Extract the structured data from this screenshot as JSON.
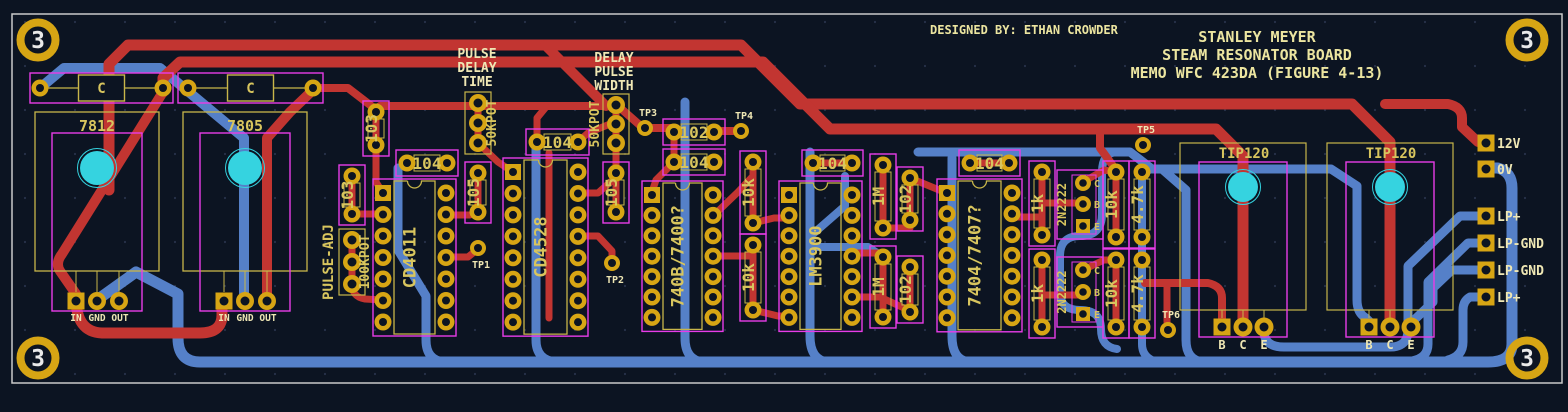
{
  "app": {
    "view": "pcb-layout-editor"
  },
  "title_block": {
    "designer": "DESIGNED BY: ETHAN CROWDER",
    "line1": "STANLEY MEYER",
    "line2": "STEAM RESONATOR BOARD",
    "line3": "MEMO WFC 423DA (FIGURE 4-13)"
  },
  "colors": {
    "background": "#0c1422",
    "grid_dot": "#273149",
    "page_border": "#c9c9c9",
    "copper_top": "#c23531",
    "copper_bottom": "#5580c8",
    "pad_gold": "#d7a514",
    "silk_yellow": "#c8b64a",
    "silk_text": "#d8c55e",
    "silk_bright": "#efe7b4",
    "courtyard_pink": "#e83ce8",
    "hole_cyan": "#35d3e0",
    "hole_number": "#e9e9e9"
  },
  "mounting_hole_label": "3",
  "mounting_holes": [
    {
      "x": 38,
      "y": 40
    },
    {
      "x": 1527,
      "y": 40
    },
    {
      "x": 38,
      "y": 358
    },
    {
      "x": 1527,
      "y": 358
    }
  ],
  "headers": [
    {
      "lines": [
        "PULSE",
        "DELAY",
        "TIME"
      ],
      "x": 477,
      "y": 58
    },
    {
      "lines": [
        "DELAY",
        "PULSE",
        "WIDTH"
      ],
      "x": 614,
      "y": 62
    }
  ],
  "capacitors": [
    {
      "label": "C",
      "x1": 40,
      "x2": 163,
      "y": 88
    },
    {
      "label": "C",
      "x1": 188,
      "x2": 313,
      "y": 88
    }
  ],
  "regulators": [
    {
      "label": "7812",
      "cx": 97,
      "pins": [
        "IN",
        "GND",
        "OUT"
      ]
    },
    {
      "label": "7805",
      "cx": 245,
      "pins": [
        "IN",
        "GND",
        "OUT"
      ]
    }
  ],
  "ics": [
    {
      "label": "CD4011",
      "colL": 383,
      "colR": 446,
      "y0": 193,
      "dy": 21.5,
      "n": 7
    },
    {
      "label": "CD4528",
      "colL": 513,
      "colR": 578,
      "y0": 172,
      "dy": 21.45,
      "n": 8
    },
    {
      "label": "740B/7400?",
      "colL": 652,
      "colR": 713,
      "y0": 195,
      "dy": 20.4,
      "n": 7
    },
    {
      "label": "LM3900",
      "colL": 789,
      "colR": 852,
      "y0": 195,
      "dy": 20.4,
      "n": 7
    },
    {
      "label": "7404/7407?",
      "colL": 947,
      "colR": 1012,
      "y0": 193,
      "dy": 20.8,
      "n": 7
    }
  ],
  "resistors_v": [
    {
      "label": "103",
      "x": 376,
      "y1": 112,
      "y2": 145
    },
    {
      "label": "103",
      "x": 352,
      "y1": 176,
      "y2": 214
    },
    {
      "label": "105",
      "x": 478,
      "y1": 173,
      "y2": 212
    },
    {
      "label": "105",
      "x": 616,
      "y1": 173,
      "y2": 212
    },
    {
      "label": "10k",
      "x": 753,
      "y1": 162,
      "y2": 223
    },
    {
      "label": "10k",
      "x": 753,
      "y1": 245,
      "y2": 310
    },
    {
      "label": "1M",
      "x": 883,
      "y1": 165,
      "y2": 228
    },
    {
      "label": "102",
      "x": 910,
      "y1": 178,
      "y2": 220
    },
    {
      "label": "1M",
      "x": 883,
      "y1": 257,
      "y2": 317
    },
    {
      "label": "102",
      "x": 910,
      "y1": 267,
      "y2": 312
    },
    {
      "label": "1k",
      "x": 1042,
      "y1": 172,
      "y2": 235
    },
    {
      "label": "10k",
      "x": 1116,
      "y1": 172,
      "y2": 237
    },
    {
      "label": "4.7k",
      "x": 1142,
      "y1": 172,
      "y2": 237
    },
    {
      "label": "1k",
      "x": 1042,
      "y1": 260,
      "y2": 327
    },
    {
      "label": "10k",
      "x": 1116,
      "y1": 260,
      "y2": 327
    },
    {
      "label": "4.7k",
      "x": 1142,
      "y1": 260,
      "y2": 327
    }
  ],
  "resistors_h": [
    {
      "label": "104",
      "x1": 407,
      "x2": 447,
      "y": 163
    },
    {
      "label": "104",
      "x1": 537,
      "x2": 578,
      "y": 142
    },
    {
      "label": "102",
      "x1": 674,
      "x2": 714,
      "y": 132
    },
    {
      "label": "104",
      "x1": 674,
      "x2": 714,
      "y": 162
    },
    {
      "label": "104",
      "x1": 813,
      "x2": 852,
      "y": 163
    },
    {
      "label": "104",
      "x1": 970,
      "x2": 1009,
      "y": 163
    }
  ],
  "pots": [
    {
      "label": "100KPOT",
      "x": 352,
      "ys": [
        240,
        262,
        284
      ],
      "lx": 369,
      "side_label": "PULSE-ADJ",
      "sx": 333
    },
    {
      "label": "50KPOT",
      "x": 478,
      "ys": [
        103,
        123,
        143
      ],
      "lx": 496,
      "side_label": "",
      "sx": 0
    },
    {
      "label": "50KPOT",
      "x": 616,
      "ys": [
        105,
        124,
        143
      ],
      "lx": 599,
      "side_label": "",
      "sx": 0
    }
  ],
  "transistors": [
    {
      "label": "2N2222",
      "x": 1083,
      "ys": [
        183,
        204,
        226
      ],
      "pin_labels": [
        "C",
        "B",
        "E"
      ]
    },
    {
      "label": "2N2222",
      "x": 1083,
      "ys": [
        270,
        292,
        314
      ],
      "pin_labels": [
        "C",
        "B",
        "E"
      ]
    }
  ],
  "power_transistors": [
    {
      "label": "TIP120",
      "cx": 1243,
      "pins": [
        "B",
        "C",
        "E"
      ]
    },
    {
      "label": "TIP120",
      "cx": 1390,
      "pins": [
        "B",
        "C",
        "E"
      ]
    }
  ],
  "test_points": [
    {
      "label": "TP1",
      "x": 478,
      "y": 248,
      "lpos": "below"
    },
    {
      "label": "TP2",
      "x": 612,
      "y": 263,
      "lpos": "below"
    },
    {
      "label": "TP3",
      "x": 645,
      "y": 128,
      "lpos": "above"
    },
    {
      "label": "TP4",
      "x": 741,
      "y": 131,
      "lpos": "above"
    },
    {
      "label": "TP5",
      "x": 1143,
      "y": 145,
      "lpos": "above"
    },
    {
      "label": "TP6",
      "x": 1168,
      "y": 330,
      "lpos": "above"
    }
  ],
  "edge_connectors": [
    {
      "label": "12V",
      "x": 1486,
      "y": 143
    },
    {
      "label": "0V",
      "x": 1486,
      "y": 169
    },
    {
      "label": "LP+",
      "x": 1486,
      "y": 216
    },
    {
      "label": "LP-GND",
      "x": 1486,
      "y": 243
    },
    {
      "label": "LP-GND",
      "x": 1486,
      "y": 270
    },
    {
      "label": "LP+",
      "x": 1486,
      "y": 297
    }
  ],
  "traces": {
    "red": [
      {
        "d": "M109,190 V64 L128,45 H741 L800,104 H1352 L1390,142 V320",
        "w": 11
      },
      {
        "d": "M1385,104 H1448 Q1462,107 1462,118 V127 L1478,142",
        "w": 10
      },
      {
        "d": "M163,92 V78 L180,62 H763 L830,129 H1216 L1243,156 V320",
        "w": 11
      },
      {
        "d": "M1100,129 V148 L1116,170",
        "w": 8
      },
      {
        "d": "M545,45 L606,106",
        "w": 10
      },
      {
        "d": "M376,110 L380,106 H618 L643,128 H674",
        "w": 8
      },
      {
        "d": "M714,131 H741",
        "w": 8
      },
      {
        "d": "M163,92 L62,254 Q55,263 60,271 L76,294",
        "w": 10
      },
      {
        "d": "M76,298 Q76,332 102,333 H200 Q222,333 222,315 V300",
        "w": 11
      },
      {
        "d": "M267,300 V138 L290,112 L313,90",
        "w": 10
      },
      {
        "d": "M313,88 H348 L374,108",
        "w": 8
      },
      {
        "d": "M376,112 V145",
        "w": 7
      },
      {
        "d": "M376,145 V182 L383,193",
        "w": 7
      },
      {
        "d": "M352,176 V214",
        "w": 7
      },
      {
        "d": "M352,214 H383",
        "w": 7
      },
      {
        "d": "M352,240 V284",
        "w": 7
      },
      {
        "d": "M352,284 Q352,297 365,299 L383,300",
        "w": 7
      },
      {
        "d": "M478,103 V143",
        "w": 7
      },
      {
        "d": "M478,173 V212",
        "w": 7
      },
      {
        "d": "M616,105 V143",
        "w": 7
      },
      {
        "d": "M616,143 V212",
        "w": 7
      },
      {
        "d": "M446,215 H470 L478,212",
        "w": 7
      },
      {
        "d": "M446,257 H468 L478,249",
        "w": 7
      },
      {
        "d": "M478,143 L498,162 L513,172",
        "w": 7
      },
      {
        "d": "M537,142 V118 L546,107",
        "w": 7
      },
      {
        "d": "M578,142 L588,133 L610,124 L616,124",
        "w": 7
      },
      {
        "d": "M549,153 V318",
        "w": 7
      },
      {
        "d": "M578,193 H598 L616,177",
        "w": 7
      },
      {
        "d": "M578,236 H598 L612,251 V261",
        "w": 7
      },
      {
        "d": "M674,132 V162",
        "w": 7
      },
      {
        "d": "M674,162 L656,180 L652,192",
        "w": 7
      },
      {
        "d": "M713,216 L738,192 L753,176",
        "w": 7
      },
      {
        "d": "M713,256 H753",
        "w": 7
      },
      {
        "d": "M753,162 V223",
        "w": 7
      },
      {
        "d": "M753,245 V310",
        "w": 7
      },
      {
        "d": "M753,223 L774,218 H789",
        "w": 7
      },
      {
        "d": "M753,310 L778,316 L789,316",
        "w": 7
      },
      {
        "d": "M813,163 H852",
        "w": 7
      },
      {
        "d": "M852,253 H883",
        "w": 7
      },
      {
        "d": "M883,165 V228",
        "w": 7
      },
      {
        "d": "M883,228 H910",
        "w": 7
      },
      {
        "d": "M883,257 V317",
        "w": 7
      },
      {
        "d": "M910,178 V220",
        "w": 7
      },
      {
        "d": "M910,267 V312",
        "w": 7
      },
      {
        "d": "M910,178 L944,192",
        "w": 7
      },
      {
        "d": "M852,297 H880 L906,309",
        "w": 7
      },
      {
        "d": "M970,163 H1009",
        "w": 7
      },
      {
        "d": "M1012,217 H1042",
        "w": 7
      },
      {
        "d": "M1042,172 V235",
        "w": 7
      },
      {
        "d": "M1042,260 V327",
        "w": 7
      },
      {
        "d": "M1042,203 H1080",
        "w": 7
      },
      {
        "d": "M1042,295 H1080",
        "w": 7
      },
      {
        "d": "M1083,182 L1104,170 L1116,172",
        "w": 7
      },
      {
        "d": "M1083,270 L1104,260 L1116,260",
        "w": 7
      },
      {
        "d": "M1116,172 V237",
        "w": 7
      },
      {
        "d": "M1116,260 V327",
        "w": 7
      },
      {
        "d": "M1145,283 H1208 Q1222,286 1222,298 V320",
        "w": 8
      },
      {
        "d": "M1167,283 V322",
        "w": 7
      }
    ],
    "blue": [
      {
        "d": "M40,88 L64,68 H160 L244,138 V296",
        "w": 10
      },
      {
        "d": "M97,300 L136,272 L178,294 V338 Q178,362 200,362 H1488 Q1512,362 1512,344 V188 Q1512,172 1498,168 L1486,168",
        "w": 11
      },
      {
        "d": "M1486,216 H1460 L1408,266 V330 Q1408,347 1390,347 H1284 Q1264,347 1264,331 V325",
        "w": 9
      },
      {
        "d": "M1486,243 H1468 L1428,282 V344 Q1428,358 1412,361",
        "w": 9
      },
      {
        "d": "M1486,270 H1452 L1433,288 V302 L1412,322 V326",
        "w": 9
      },
      {
        "d": "M1486,297 H1470 Q1463,301 1463,310 V342 Q1463,356 1448,360",
        "w": 9
      },
      {
        "d": "M536,142 V340 Q536,360 556,362",
        "w": 9
      },
      {
        "d": "M398,168 V250 L426,296 V340 Q426,360 444,362",
        "w": 9
      },
      {
        "d": "M685,102 V338 Q685,360 703,362",
        "w": 9
      },
      {
        "d": "M810,152 V336 Q810,360 828,362",
        "w": 9
      },
      {
        "d": "M845,176 V206 L814,233",
        "w": 8
      },
      {
        "d": "M810,247 H868 L883,257",
        "w": 8
      },
      {
        "d": "M952,158 V336 Q952,360 969,362",
        "w": 9
      },
      {
        "d": "M918,152 H1130 L1152,169 H1162 L1186,190 V340 Q1186,360 1203,362",
        "w": 9
      },
      {
        "d": "M1152,169 L1142,172 V237",
        "w": 8
      },
      {
        "d": "M1142,237 V260",
        "w": 8
      },
      {
        "d": "M1142,260 V327 V344 Q1142,358 1157,362",
        "w": 8
      },
      {
        "d": "M1162,169 H1331 L1357,186 V300 Q1357,313 1366,318 L1370,322",
        "w": 9
      },
      {
        "d": "M1118,152 Q1102,152 1102,172 V214 Q1102,236 1080,236 Q1060,236 1060,256 V292 Q1060,310 1080,310 Q1101,310 1101,329 Q1101,347 1117,349",
        "w": 8
      }
    ]
  }
}
